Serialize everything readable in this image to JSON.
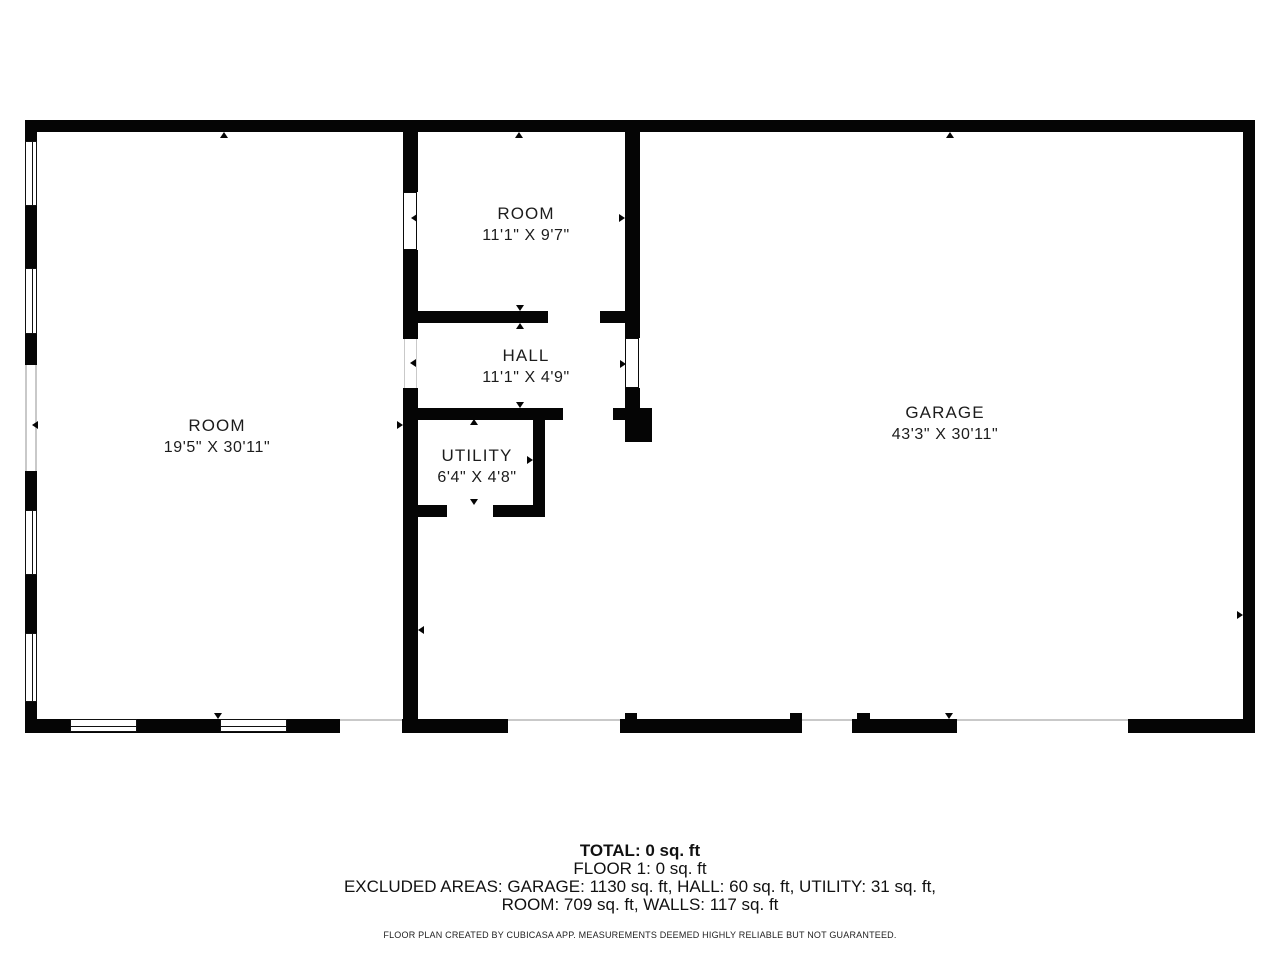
{
  "plan": {
    "rooms": [
      {
        "id": "left-room",
        "name": "ROOM",
        "dims": "19'5\" X 30'11\""
      },
      {
        "id": "mid-room",
        "name": "ROOM",
        "dims": "11'1\" X 9'7\""
      },
      {
        "id": "hall",
        "name": "HALL",
        "dims": "11'1\" X 4'9\""
      },
      {
        "id": "utility",
        "name": "UTILITY",
        "dims": "6'4\" X 4'8\""
      },
      {
        "id": "garage",
        "name": "GARAGE",
        "dims": "43'3\" X 30'11\""
      }
    ]
  },
  "summary": {
    "total": "TOTAL: 0 sq. ft",
    "floor": "FLOOR 1: 0 sq. ft",
    "excluded_line1": "EXCLUDED AREAS: GARAGE: 1130 sq. ft, HALL: 60 sq. ft, UTILITY: 31 sq. ft,",
    "excluded_line2": "ROOM: 709 sq. ft, WALLS: 117 sq. ft",
    "disclaimer": "FLOOR PLAN CREATED BY CUBICASA APP. MEASUREMENTS DEEMED HIGHLY RELIABLE BUT NOT GUARANTEED."
  },
  "colors": {
    "wall": "#050505",
    "background": "#ffffff",
    "opening_line": "#c9c9c9",
    "text": "#1c1c1c"
  }
}
